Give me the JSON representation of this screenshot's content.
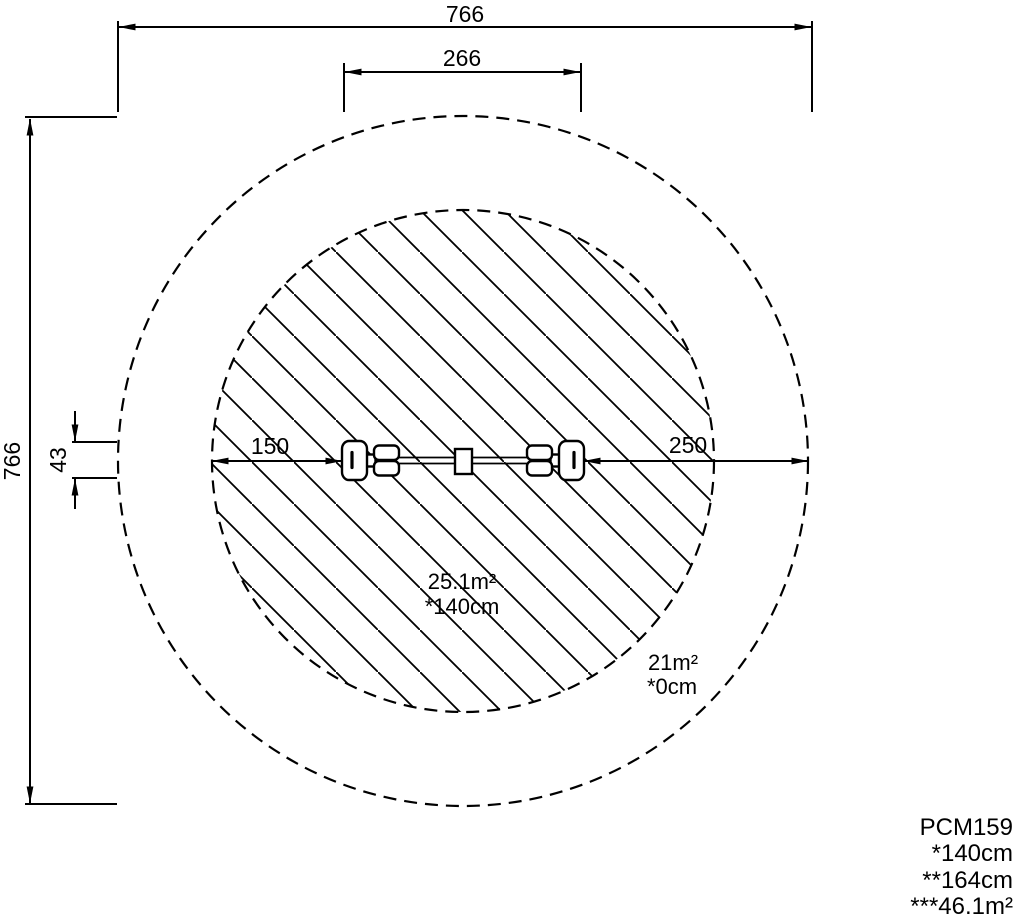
{
  "drawing": {
    "dimensions": {
      "overall_width": "766",
      "equipment_length": "266",
      "overall_height": "766",
      "equipment_width": "43",
      "clearance_left": "150",
      "clearance_right": "250"
    },
    "inner_zone": {
      "area": "25.1m²",
      "height_marking": "*140cm"
    },
    "outer_zone": {
      "area": "21m²",
      "height_marking": "*0cm"
    },
    "legend": {
      "product_code": "PCM159",
      "fall_height": "*140cm",
      "equipment_height": "**164cm",
      "total_area": "***46.1m²"
    },
    "colors": {
      "line": "#000000",
      "background": "#ffffff"
    }
  }
}
